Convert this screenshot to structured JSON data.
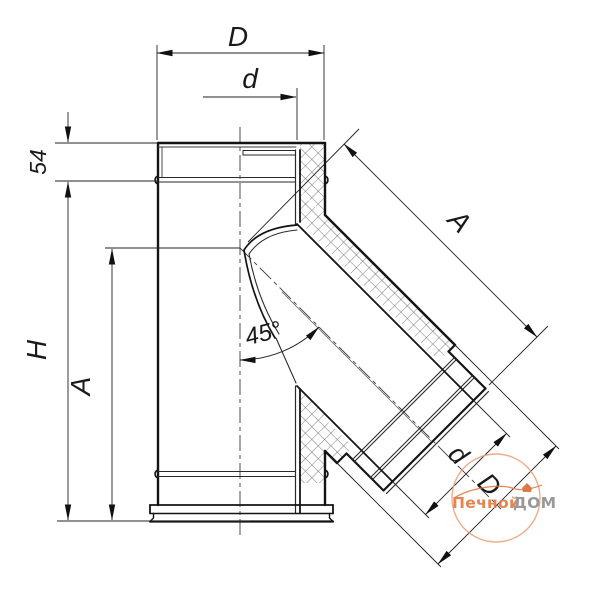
{
  "drawing": {
    "dimensions": {
      "outer_diameter_top": "D",
      "inner_diameter_top": "d",
      "collar_height": "54",
      "total_height": "H",
      "branch_axis_height": "A",
      "branch_angle": "45°",
      "branch_length": "A",
      "branch_inner_diameter": "d",
      "branch_outer_diameter": "D"
    },
    "watermark": {
      "brand_orange": "Печной",
      "brand_gray": "ДОМ",
      "accent_color": "#e4763b",
      "gray_color": "#8f8f8f"
    },
    "colors": {
      "line": "#141414",
      "thin_line": "#3a3a3a",
      "hatch": "#4a4a4a",
      "background": "#ffffff"
    }
  }
}
